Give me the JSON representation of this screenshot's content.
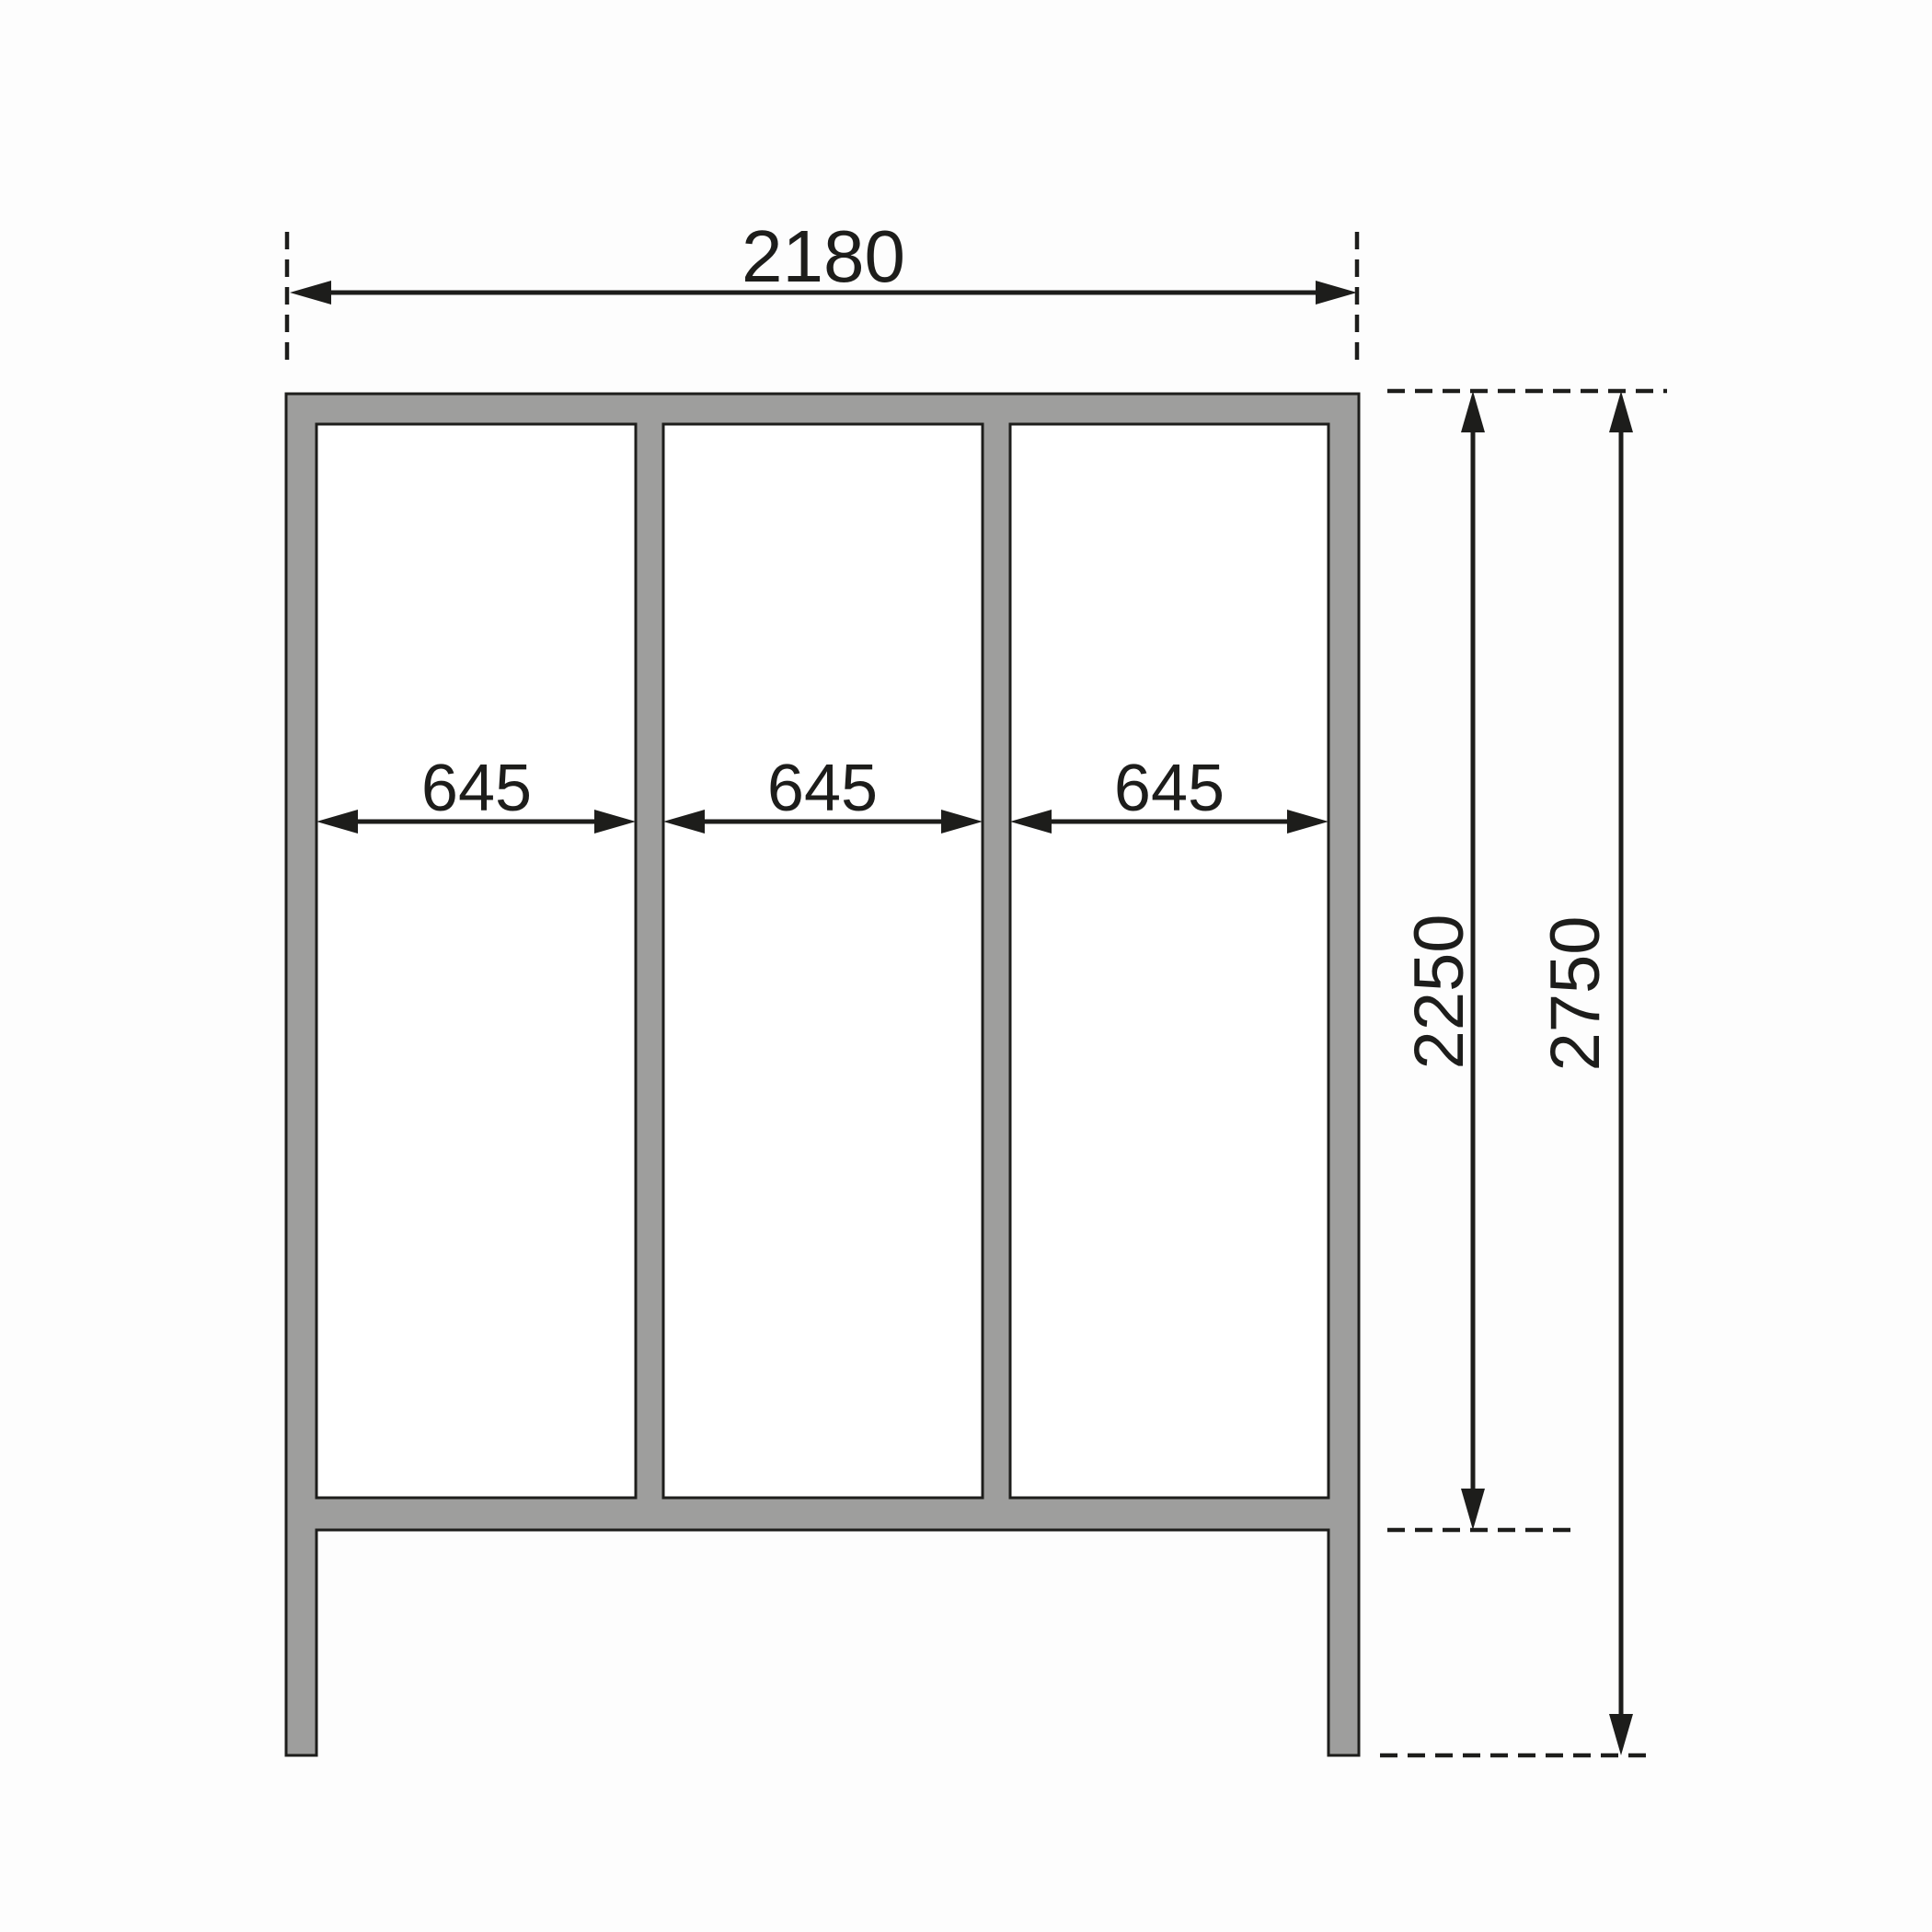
{
  "dimensions": {
    "overall_width": "2180",
    "panel_width_1": "645",
    "panel_width_2": "645",
    "panel_width_3": "645",
    "frame_height": "2250",
    "total_height": "2750"
  },
  "colors": {
    "frame_fill": "#9e9e9d",
    "panel_fill": "#ffffff",
    "line": "#1d1d1b",
    "background": "#fdfdfd"
  }
}
